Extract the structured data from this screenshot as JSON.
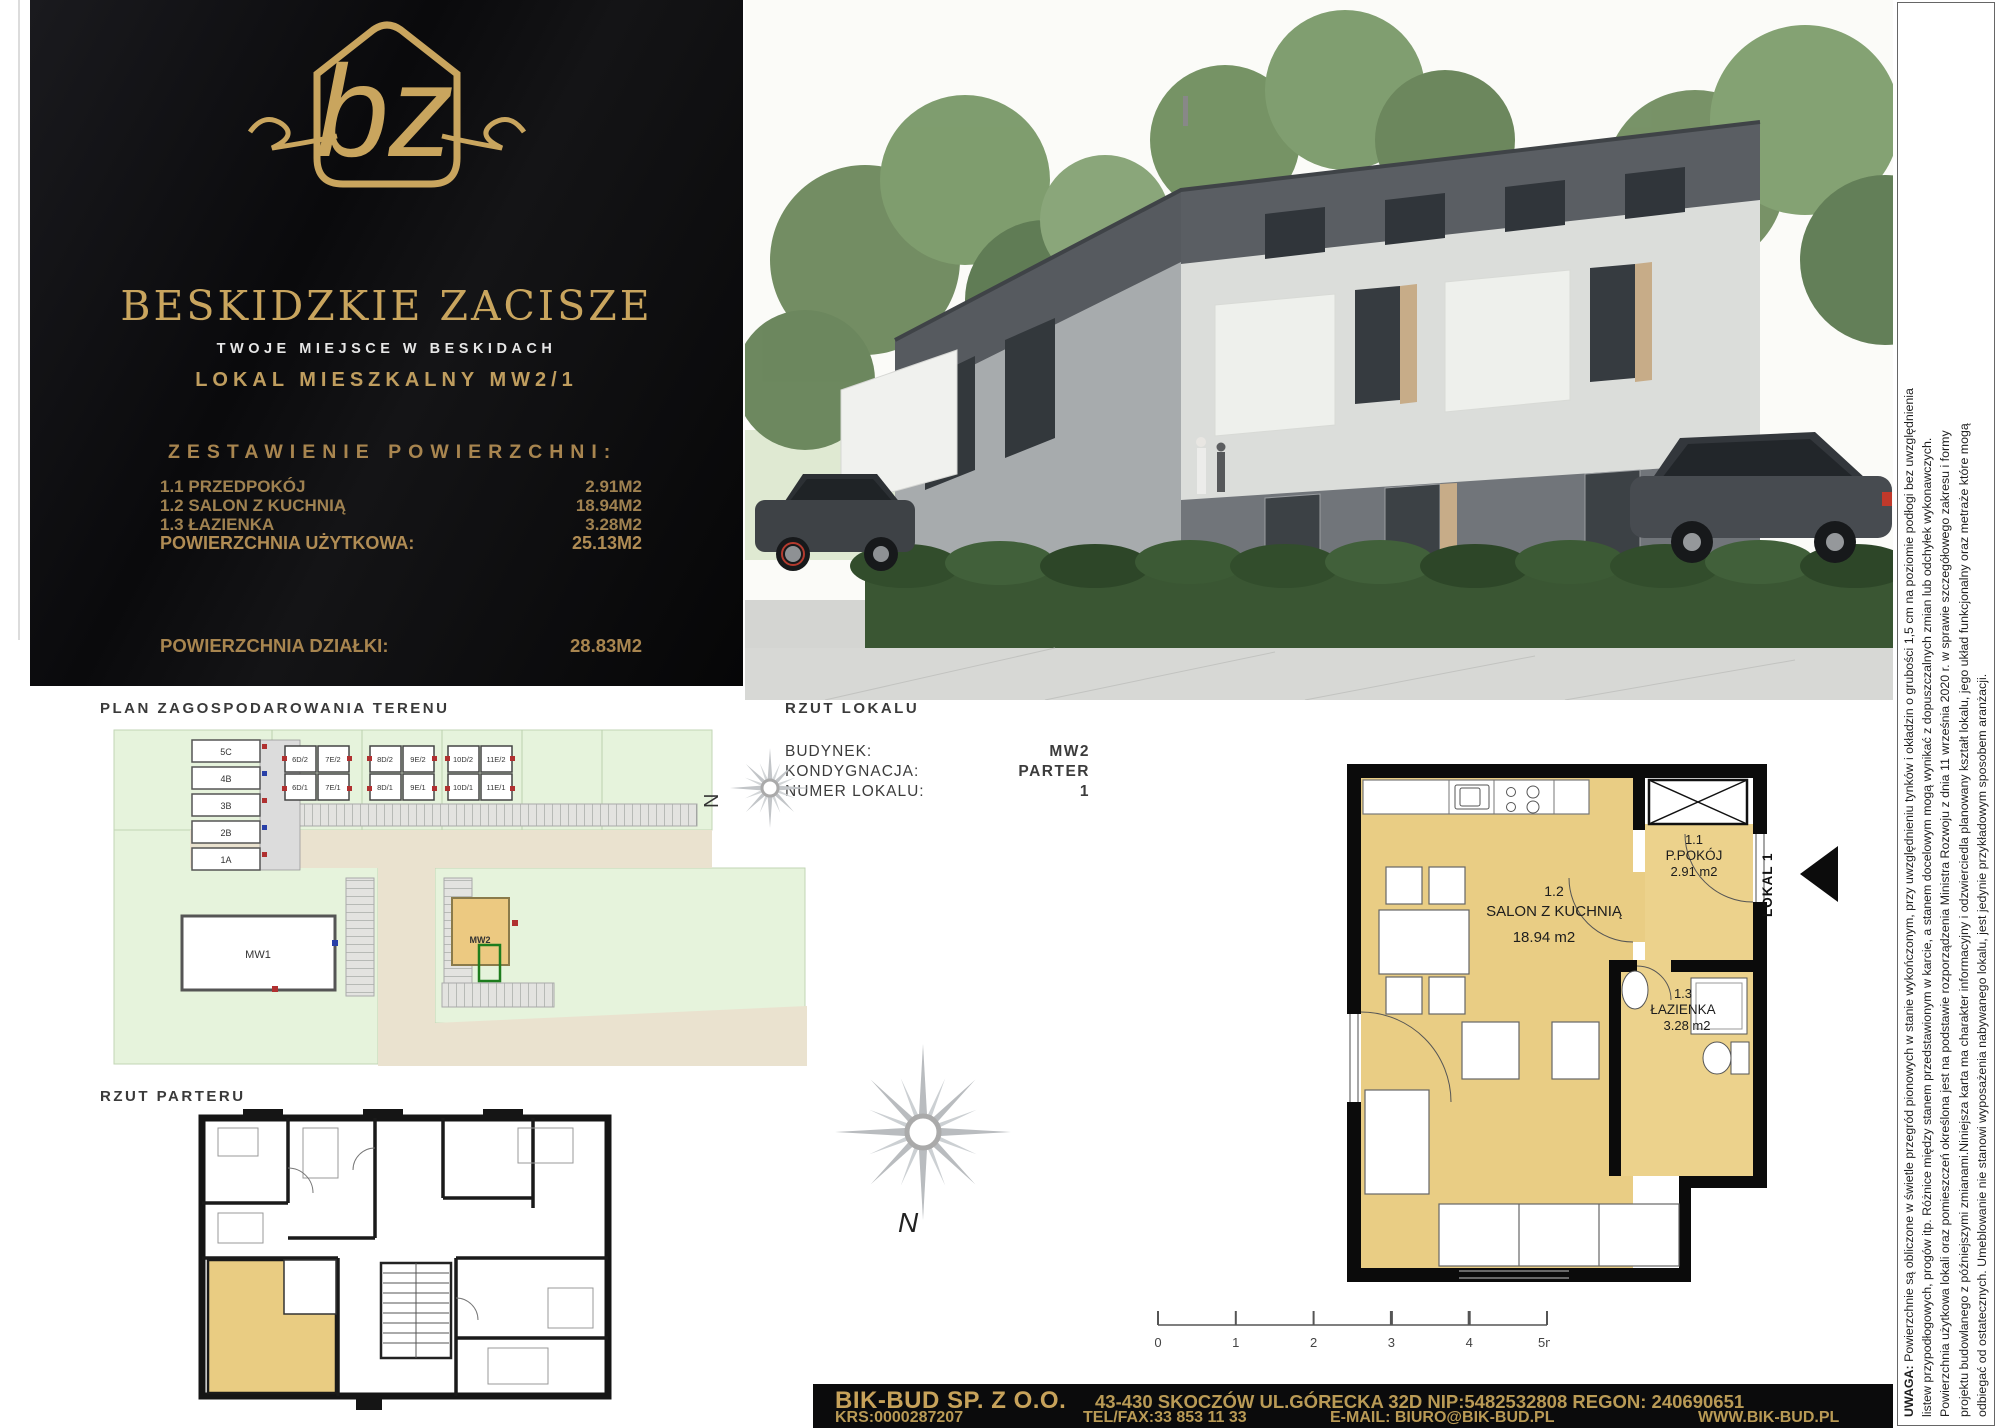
{
  "brand": {
    "monogram": "bz",
    "name": "BESKIDZKIE ZACISZE",
    "tagline": "TWOJE MIEJSCE W BESKIDACH",
    "unit_title": "LOKAL MIESZKALNY MW2/1",
    "gold_color": "#c2a05c",
    "panel_color": "#0b0b0d"
  },
  "area_summary": {
    "heading": "ZESTAWIENIE POWIERZCHNI:",
    "rows": [
      {
        "label": "1.1 PRZEDPOKÓJ",
        "value": "2.91M2"
      },
      {
        "label": "1.2 SALON Z KUCHNIĄ",
        "value": "18.94M2"
      },
      {
        "label": "1.3 ŁAZIENKA",
        "value": "3.28M2"
      }
    ],
    "usable_label": "POWIERZCHNIA UŻYTKOWA:",
    "usable_value": "25.13M2",
    "plot_label": "POWIERZCHNIA DZIAŁKI:",
    "plot_value": "28.83M2"
  },
  "site_plan": {
    "title": "PLAN ZAGOSPODAROWANIA TERENU",
    "row_houses": [
      "5C",
      "4B",
      "3B",
      "2B",
      "1A"
    ],
    "duplex_groups": [
      [
        "6D/2",
        "7E/2",
        "6D/1",
        "7E/1"
      ],
      [
        "8D/2",
        "9E/2",
        "8D/1",
        "9E/1"
      ],
      [
        "10D/2",
        "11E/2",
        "10D/1",
        "11E/1"
      ]
    ],
    "buildings": {
      "mw1": "MW1",
      "mw2": "MW2"
    },
    "compass": "N"
  },
  "ground_floor": {
    "title": "RZUT PARTERU"
  },
  "unit_plan": {
    "title": "RZUT LOKALU",
    "fields": [
      {
        "label": "BUDYNEK:",
        "value": "MW2"
      },
      {
        "label": "KONDYGNACJA:",
        "value": "PARTER"
      },
      {
        "label": "NUMER LOKALU:",
        "value": "1"
      }
    ],
    "rooms": [
      {
        "id": "1.1",
        "name": "P.POKÓJ",
        "area": "2.91 m2"
      },
      {
        "id": "1.2",
        "name": "SALON Z KUCHNIĄ",
        "area": "18.94 m2"
      },
      {
        "id": "1.3",
        "name": "ŁAZIENKA",
        "area": "3.28 m2"
      }
    ],
    "unit_label": "LOKAL 1",
    "compass": "N",
    "scale_ticks": [
      "0",
      "1",
      "2",
      "3",
      "4",
      "5m"
    ],
    "floor_color": "#e9cd84"
  },
  "disclaimer": {
    "warning_label": "UWAGA:",
    "lines": [
      " Powierzchnie są obliczone w świetle przegród pionowych w stanie wykończonym, przy uwzględnieniu tynków i okładzin o grubości 1,5 cm na poziomie podłogi bez uwzględnienia",
      "listew przypodłogowych, progów itp. Różnice między stanem przedstawionym w karcie, a stanem docelowym mogą wynikać z dopuszczalnych zmian lub odchyłek wykonawczych.",
      "Powierzchnia użytkowa lokali oraz pomieszczeń określona jest na podstawie rozporządzenia Ministra Rozwoju z dnia 11 września 2020 r. w sprawie szczegółowego zakresu i formy",
      "projektu budowlanego z późniejszymi zmianami.Niniejsza karta ma charakter informacyjny i odzwierciedla planowany kształt lokalu, jego układ funkcjonalny oraz metraże które mogą",
      "odbiegać od ostatecznych. Umeblowanie nie stanowi wyposażenia nabywanego lokalu, jest jedynie przykładowym sposobem aranżacji."
    ]
  },
  "footer": {
    "company": "BIK-BUD SP. Z O.O.",
    "address": "43-430 SKOCZÓW UL.GÓRECKA 32D NIP:5482532808 REGON: 240690651",
    "krs": "KRS:0000287207",
    "phone": "TEL/FAX:33 853 11 33",
    "email": "E-MAIL: BIURO@BIK-BUD.PL",
    "website": "WWW.BIK-BUD.PL"
  }
}
